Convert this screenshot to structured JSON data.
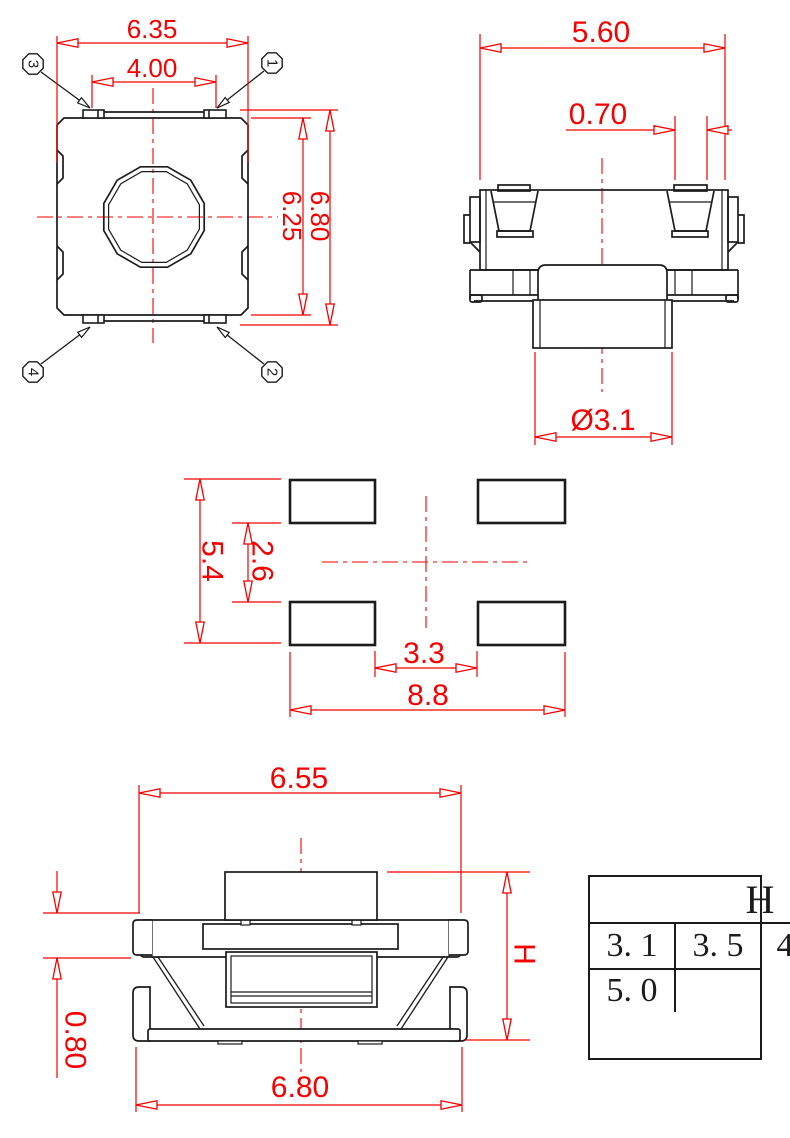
{
  "colors": {
    "dimension_red": "#f60000",
    "line_black": "#1b1b1b",
    "background": "#ffffff"
  },
  "views": {
    "top": {
      "dim_width": "6.35",
      "dim_tab_span": "4.00",
      "dim_body_height": "6.25",
      "dim_overall_height": "6.80",
      "pins": {
        "p1": "1",
        "p2": "2",
        "p3": "3",
        "p4": "4"
      }
    },
    "side": {
      "dim_width": "5.60",
      "dim_clip_width": "0.70",
      "dim_stem_diameter": "Ø3.1"
    },
    "land_pattern": {
      "dim_pad_outer_vertical": "5.4",
      "dim_pad_gap_vertical": "2.6",
      "dim_pad_gap_horizontal": "3.3",
      "dim_pad_outer_horizontal": "8.8"
    },
    "front": {
      "dim_top_width": "6.55",
      "dim_bottom_width": "6.80",
      "dim_foot_height": "0.80",
      "dim_height_symbol": "H"
    }
  },
  "height_table": {
    "header": "H",
    "rows": [
      [
        "3. 1",
        "3. 5"
      ],
      [
        "4. 3",
        "4. 5"
      ],
      [
        "5. 0",
        ""
      ]
    ]
  }
}
